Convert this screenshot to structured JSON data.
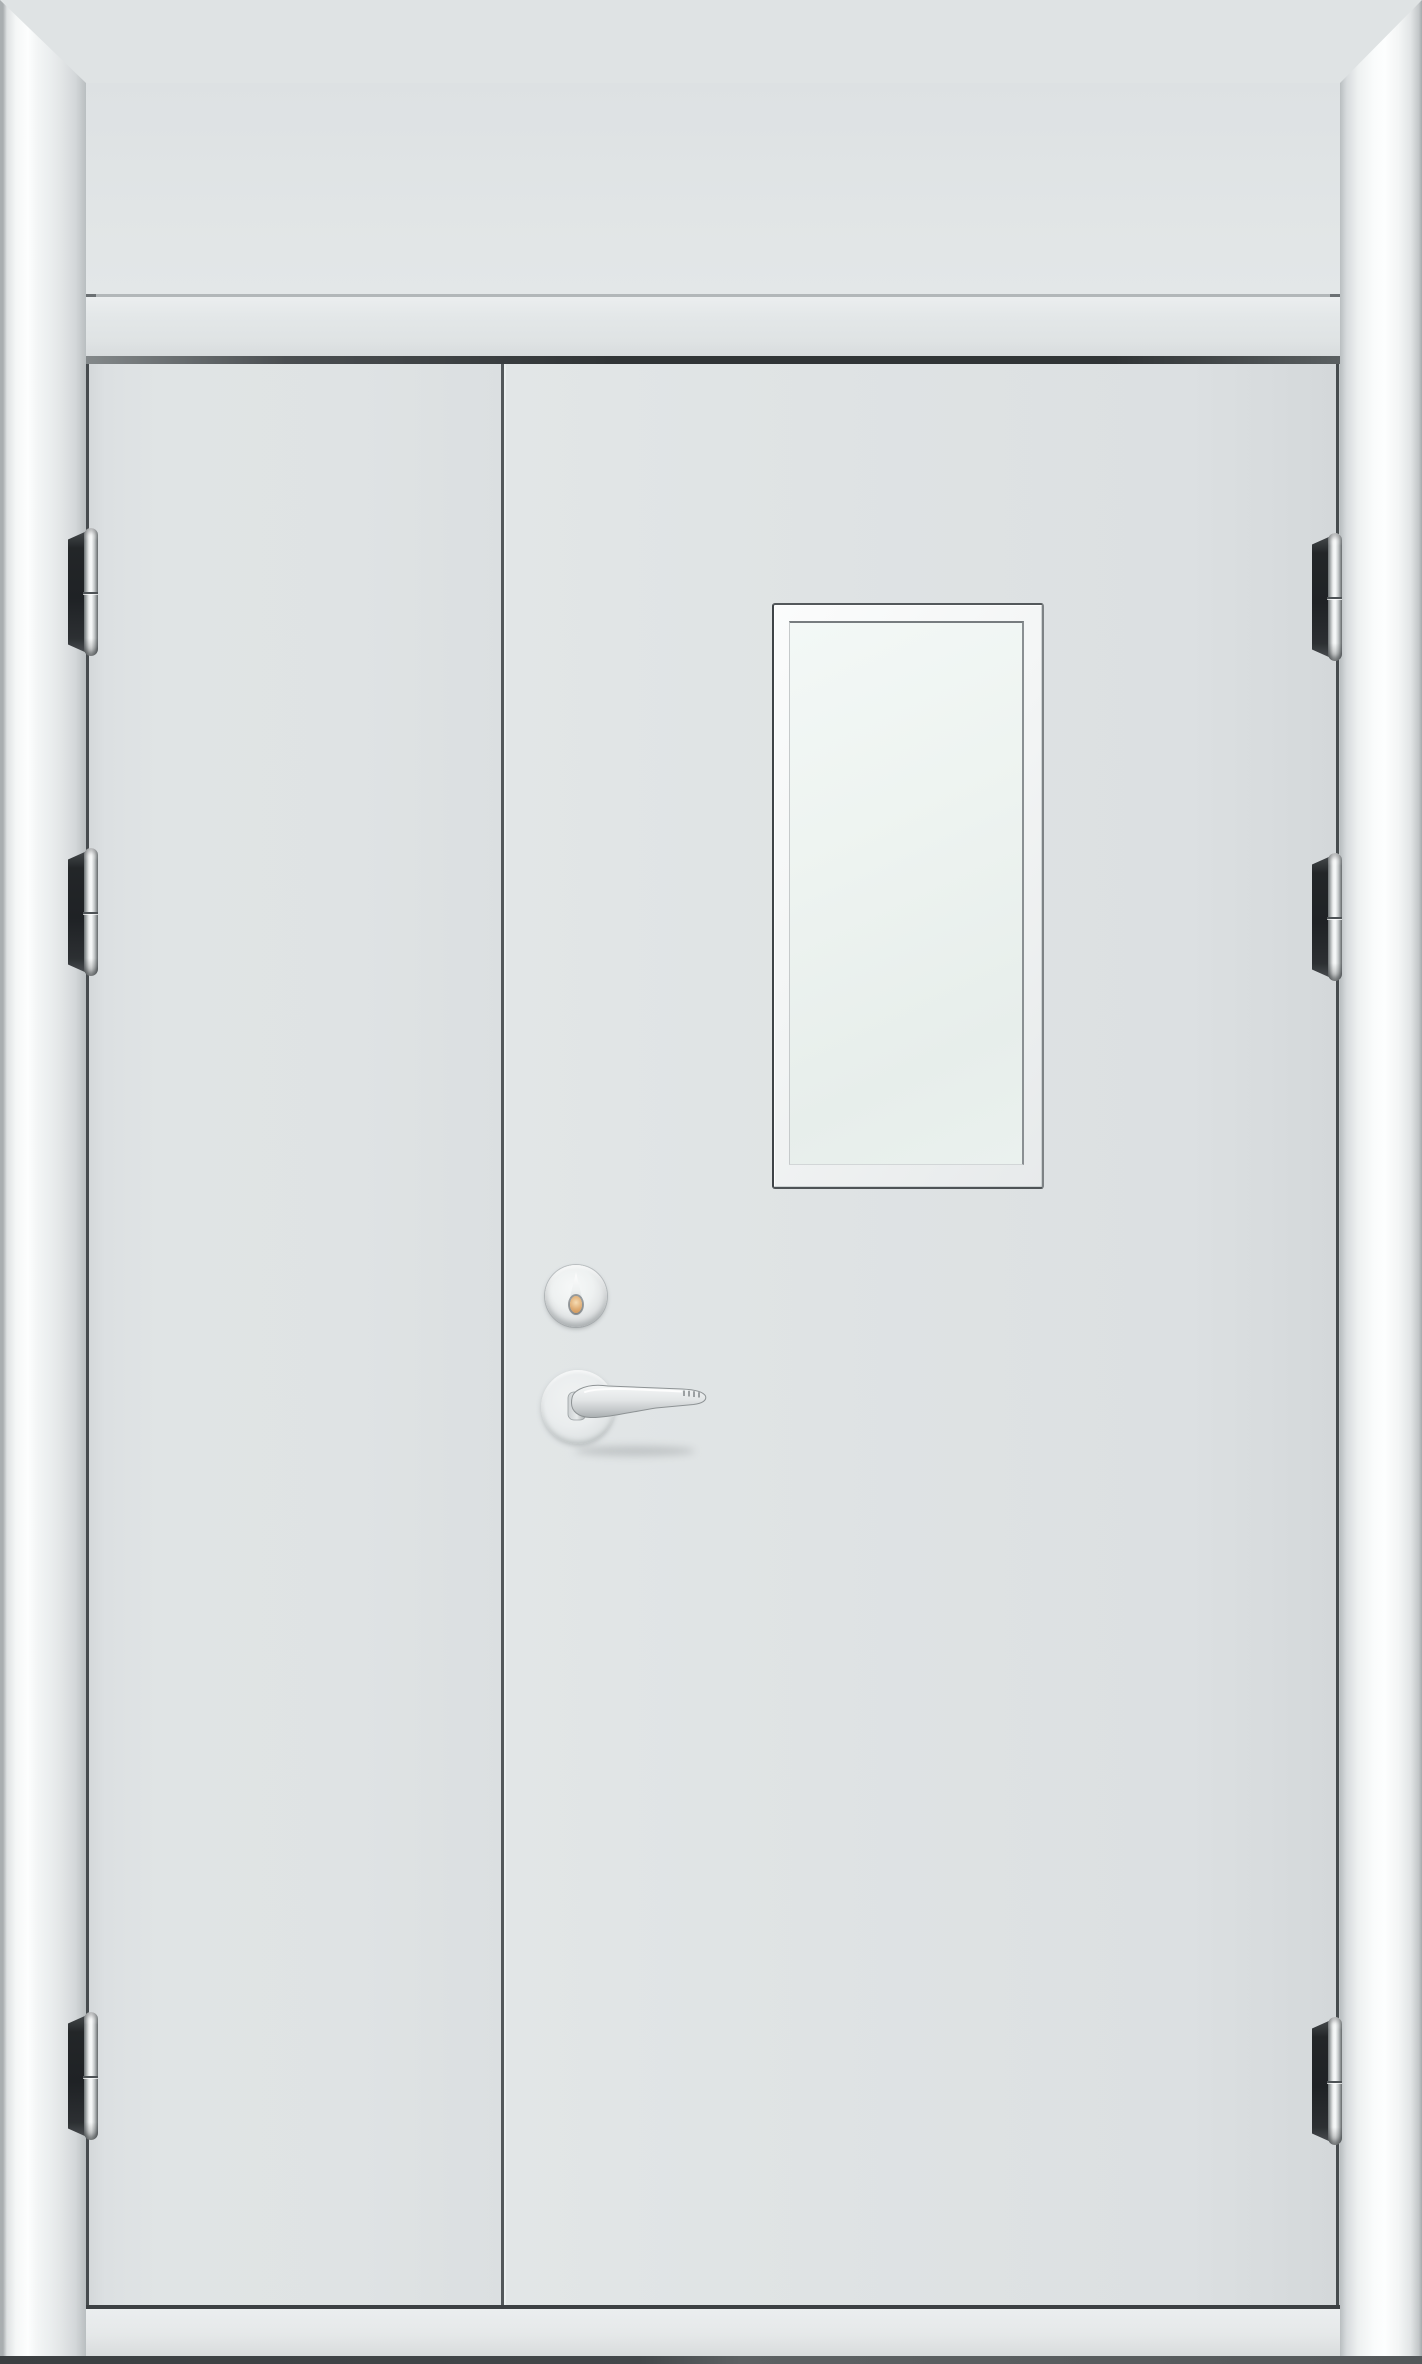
{
  "image": {
    "kind": "product photograph",
    "subject": "White double-leaf steel fire door with transom panel, closed, front view",
    "background": "none (full-bleed door and frame)"
  },
  "door": {
    "frame": "white glossy molded steel architrave with mitered corners, no bottom sill member",
    "transom": "fixed flush transom panel above the leaves with one horizontal seam",
    "leaves": {
      "left": "narrow inactive leaf, plain",
      "right": "wide active leaf carrying vision window, cylinder and lever handle"
    },
    "vision_panel": "vertical rectangular glazed vision window with white beveled frame and pale frosted glass",
    "hardware": {
      "lock_cylinder": "round satin-steel escutcheon with brass-toned keyhole",
      "handle": "satin stainless lever handle on round rose, pointing right with serrated upturned tip",
      "hinges_count": 6,
      "hinge_positions": [
        "left-top",
        "left-upper-middle",
        "left-bottom",
        "right-top",
        "right-upper-middle",
        "right-bottom"
      ],
      "hinge_style": "dark knuckle leaf with bright polished barrel and center seam"
    },
    "threshold": "light gray floor strip under the leaves with dark floor shadow line at the very bottom"
  },
  "colors": {
    "frame-white": "#f4f6f6",
    "frame-highlight": "#fdfefe",
    "frame-edge": "#a9aeb0",
    "panel-gray": "#dfe3e4",
    "edge-dark": "#464b4e",
    "head-bar-dark": "#303436",
    "glass-tint": "#edf3f0",
    "hinge-leaf-dark": "#232628",
    "hinge-barrel-light": "#f8fafa",
    "keyhole-brass": "#dfad74",
    "threshold-gray": "#e5e8e9",
    "floor-dark": "#43474a"
  }
}
